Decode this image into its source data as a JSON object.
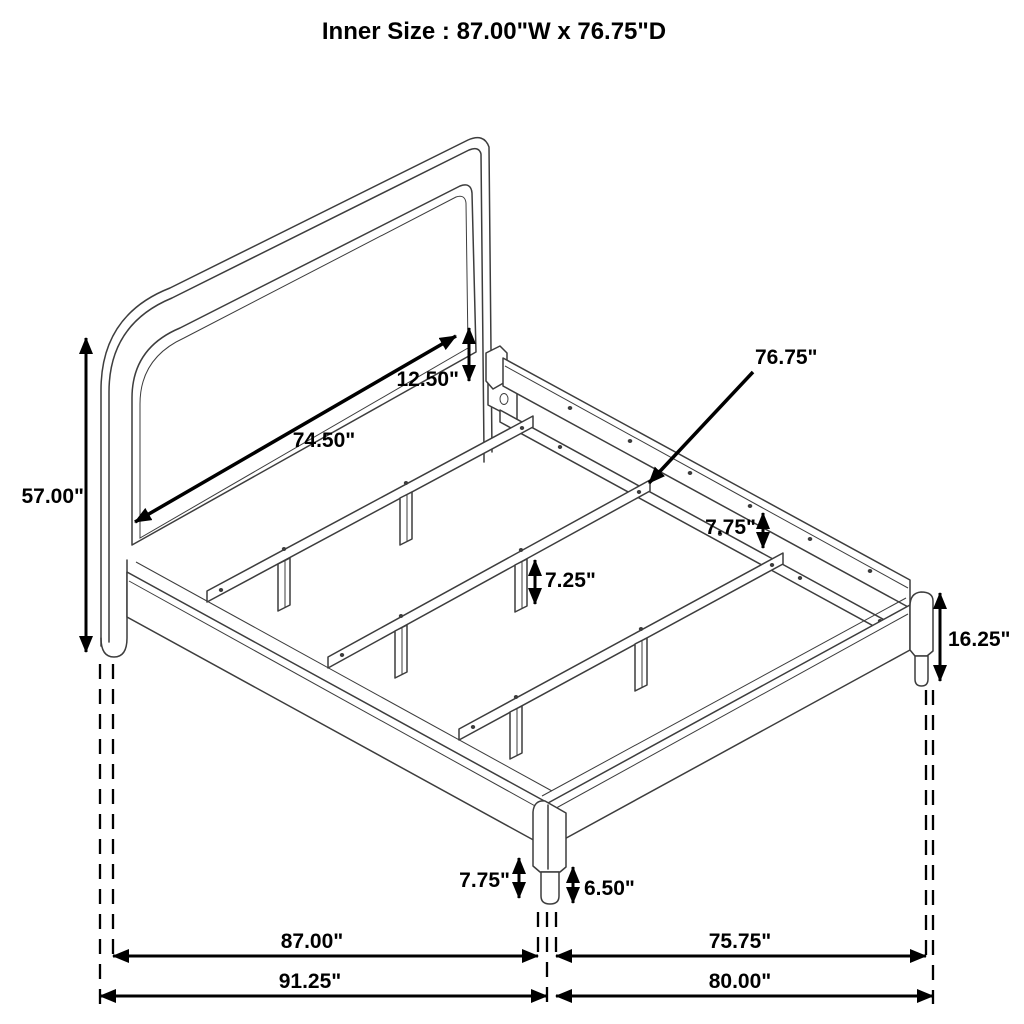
{
  "title": "Inner Size : 87.00\"W x 76.75\"D",
  "labels": {
    "headboard_height": "57.00\"",
    "headboard_panel_width": "74.50\"",
    "headboard_panel_height": "12.50\"",
    "inner_depth_pointer": "76.75\"",
    "rail_to_slat_drop": "7.75\"",
    "slat_leg_height": "7.25\"",
    "footboard_height": "16.25\"",
    "side_rail_height": "7.75\"",
    "front_leg_height": "6.50\"",
    "inner_width": "87.00\"",
    "inner_depth": "75.75\"",
    "overall_width": "91.25\"",
    "overall_depth": "80.00\""
  },
  "colors": {
    "drawing_line": "#3d3d3d",
    "annotation": "#000000",
    "background": "#ffffff"
  }
}
